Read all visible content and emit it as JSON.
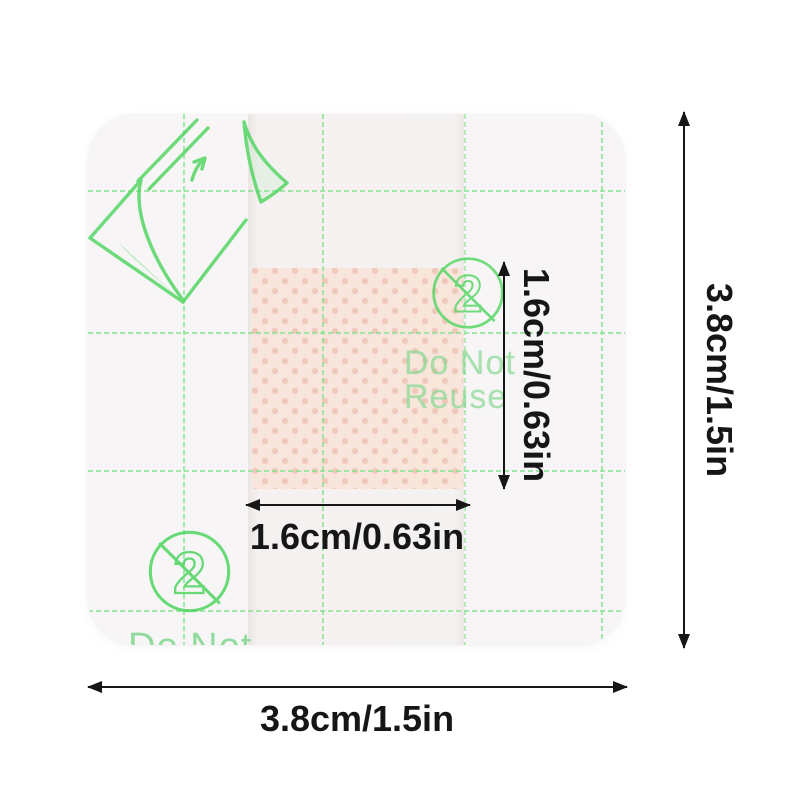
{
  "image_type": "product-dimension-photo",
  "bandage": {
    "reuse_symbol_digit": "2",
    "do_not_reuse": {
      "line1": "Do Not",
      "line2": "Reuse"
    },
    "bottom_text": "Do Not"
  },
  "dimensions": {
    "pad_width_label": "1.6cm/0.63in",
    "pad_height_label": "1.6cm/0.63in",
    "overall_width_label": "3.8cm/1.5in",
    "overall_height_label": "3.8cm/1.5in"
  },
  "colors": {
    "ink_green": "#4fd560",
    "grid_green": "#86e392",
    "text_green": "#7fd78d",
    "pad_base": "#f9e5da",
    "pad_dot": "#eec6b6",
    "dim_ink": "#161616",
    "bandage_bg": "#f7f5f6",
    "page_bg": "#ffffff"
  }
}
